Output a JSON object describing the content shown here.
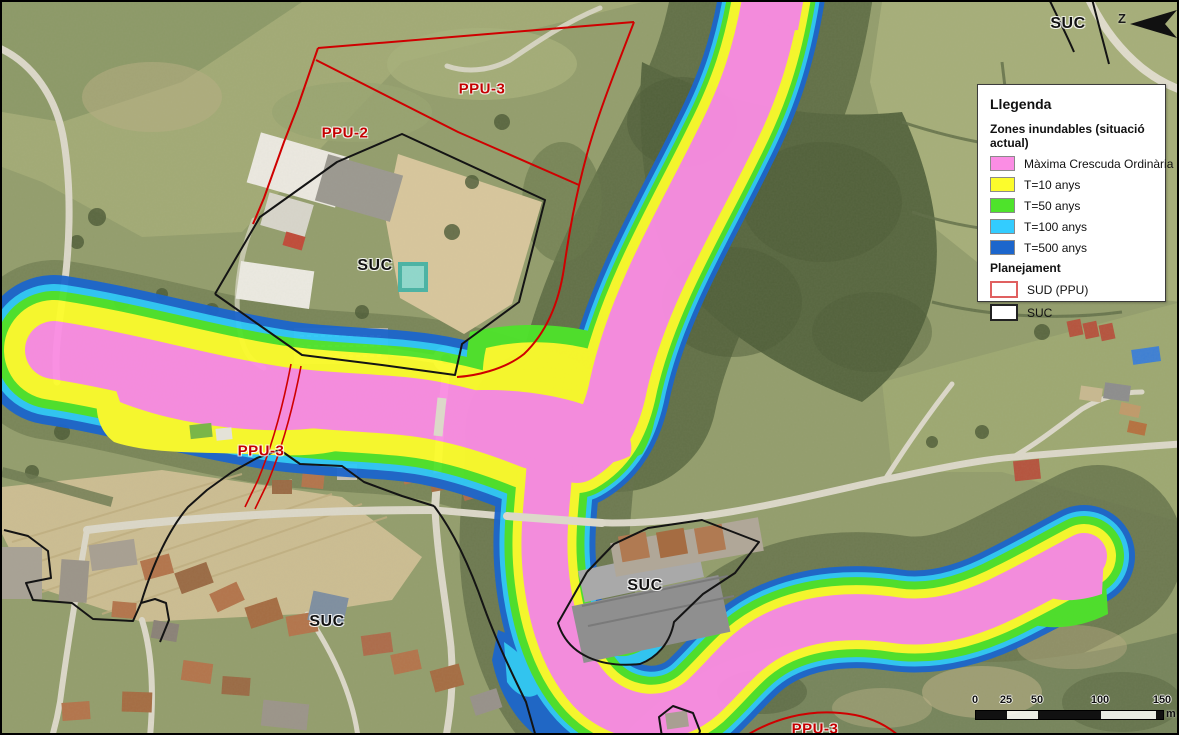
{
  "map_labels": [
    {
      "text": "PPU-3",
      "color": "#c40000"
    },
    {
      "text": "PPU-2",
      "color": "#c40000"
    },
    {
      "text": "SUC",
      "color": "#111111"
    },
    {
      "text": "PPU-3",
      "color": "#c40000"
    },
    {
      "text": "SUC",
      "color": "#111111"
    },
    {
      "text": "SUC",
      "color": "#111111"
    },
    {
      "text": "SUC",
      "color": "#111111"
    },
    {
      "text": "PPU-3",
      "color": "#c40000"
    }
  ],
  "north_arrow": {
    "label": "Z"
  },
  "legend": {
    "title": "Llegenda",
    "flood_section_title": "Zones inundables (situació actual)",
    "flood_items": [
      {
        "label": "Màxima Crescuda Ordinària",
        "color": "#fb8de4"
      },
      {
        "label": "T=10 anys",
        "color": "#fcfc2c"
      },
      {
        "label": "T=50 anys",
        "color": "#4ee32b"
      },
      {
        "label": "T=100 anys",
        "color": "#33ccff"
      },
      {
        "label": "T=500 anys",
        "color": "#1c66cc"
      }
    ],
    "planning_section_title": "Planejament",
    "planning_items": [
      {
        "label": "SUD (PPU)",
        "border_color": "#e06060"
      },
      {
        "label": "SUC",
        "border_color": "#222222"
      }
    ]
  },
  "scale_bar": {
    "tick_labels": [
      "0",
      "25",
      "50",
      "100",
      "150"
    ],
    "unit": "m"
  }
}
